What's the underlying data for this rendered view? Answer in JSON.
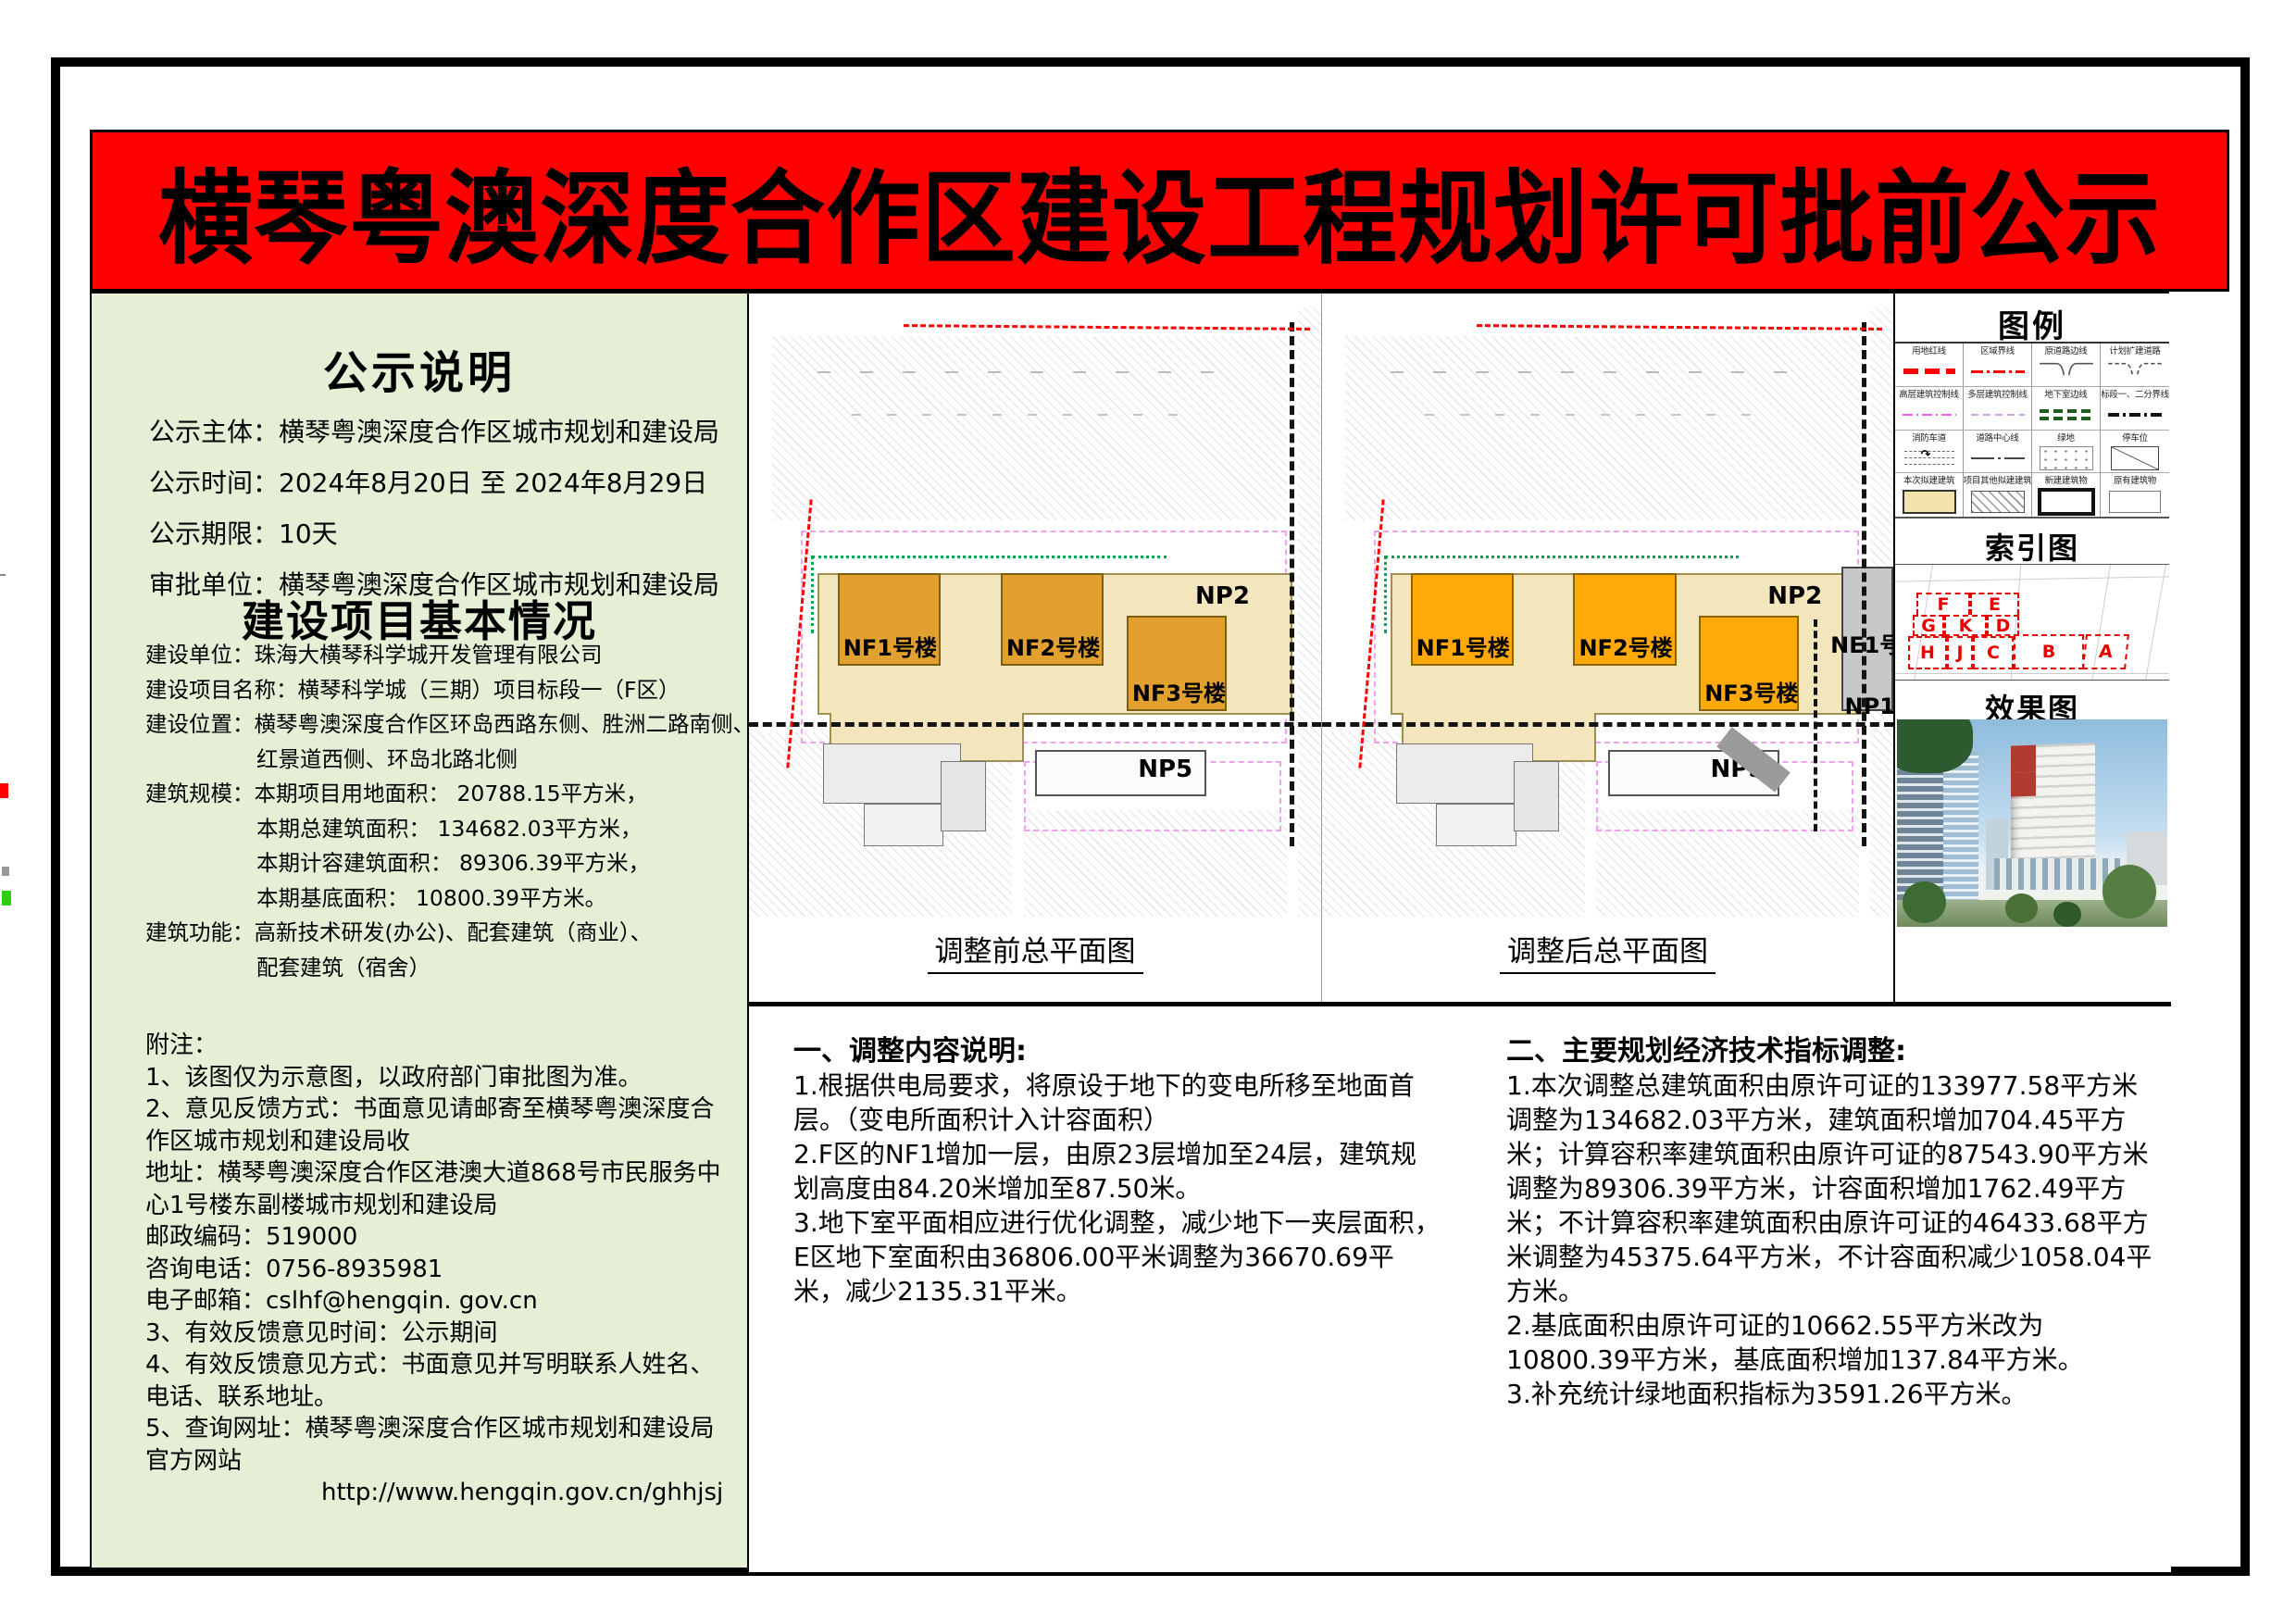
{
  "banner": {
    "title": "横琴粤澳深度合作区建设工程规划许可批前公示",
    "bg_color": "#FE0000",
    "text_color": "#000000"
  },
  "notice": {
    "title": "公示说明",
    "rows": [
      {
        "label": "公示主体：",
        "value": "横琴粤澳深度合作区城市规划和建设局"
      },
      {
        "label": "公示时间：",
        "value": "2024年8月20日  至  2024年8月29日"
      },
      {
        "label": "公示期限：",
        "value": "10天"
      },
      {
        "label": "审批单位：",
        "value": "横琴粤澳深度合作区城市规划和建设局"
      }
    ]
  },
  "project": {
    "title": "建设项目基本情况",
    "lines": [
      "建设单位：珠海大横琴科学城开发管理有限公司",
      "建设项目名称：横琴科学城（三期）项目标段一（F区）",
      "建设位置：横琴粤澳深度合作区环岛西路东侧、胜洲二路南侧、",
      "红景道西侧、环岛北路北侧",
      "建筑规模：本期项目用地面积：  20788.15平方米，",
      "本期总建筑面积：    134682.03平方米，",
      "本期计容建筑面积： 89306.39平方米，",
      "本期基底面积：     10800.39平方米。",
      "建筑功能：高新技术研发(办公)、配套建筑（商业）、",
      "配套建筑（宿舍）"
    ]
  },
  "notes": {
    "title": "附注：",
    "paragraphs": [
      "1、该图仅为示意图，以政府部门审批图为准。",
      "2、意见反馈方式：书面意见请邮寄至横琴粤澳深度合作区城市规划和建设局收",
      "地址：横琴粤澳深度合作区港澳大道868号市民服务中心1号楼东副楼城市规划和建设局",
      "邮政编码：519000",
      "咨询电话：0756-8935981",
      "电子邮箱：cslhf@hengqin. gov.cn",
      "3、有效反馈意见时间：公示期间",
      "4、有效反馈意见方式：书面意见并写明联系人姓名、电话、联系地址。",
      "5、查询网址：横琴粤澳深度合作区城市规划和建设局官方网站",
      "http://www.hengqin.gov.cn/ghhjsj"
    ]
  },
  "plans": {
    "before": {
      "caption": "调整前总平面图",
      "buildings": {
        "nf1": "NF1号楼",
        "nf2": "NF2号楼",
        "nf3": "NF3号楼",
        "np2": "NP2",
        "np5": "NP5"
      }
    },
    "after": {
      "caption": "调整后总平面图",
      "buildings": {
        "nf1": "NF1号楼",
        "nf2": "NF2号楼",
        "nf3": "NF3号楼",
        "np2": "NP2",
        "np5": "NP5",
        "ne1": "NE1号楼",
        "np1": "NP1"
      }
    },
    "colors": {
      "tower_before": "#E2A02F",
      "tower_after": "#FFA90A",
      "podium": "#F4E6BC",
      "boundary_red": "#FF0000",
      "control_magenta": "#F0A2F0",
      "green_line": "#00A651"
    }
  },
  "legend": {
    "title": "图例",
    "items": [
      {
        "label": "用地红线",
        "sym": "red-dash"
      },
      {
        "label": "区域界线",
        "sym": "red-dashdot"
      },
      {
        "label": "原道路边线",
        "sym": "road-edge"
      },
      {
        "label": "计划扩建道路",
        "sym": "road-planned"
      },
      {
        "label": "高层建筑控制线",
        "sym": "magenta-dashdot"
      },
      {
        "label": "多层建筑控制线",
        "sym": "purple-dash"
      },
      {
        "label": "地下室边线",
        "sym": "green-dash"
      },
      {
        "label": "标段一、二分界线",
        "sym": "black-dashdot"
      },
      {
        "label": "消防车道",
        "sym": "fire-lane"
      },
      {
        "label": "道路中心线",
        "sym": "centerline"
      },
      {
        "label": "绿地",
        "sym": "green-space"
      },
      {
        "label": "停车位",
        "sym": "parking"
      },
      {
        "label": "本次拟建建筑",
        "sym": "proposed"
      },
      {
        "label": "项目其他拟建建筑",
        "sym": "other-proposed"
      },
      {
        "label": "新建建筑物",
        "sym": "new-building"
      },
      {
        "label": "原有建筑物",
        "sym": "existing-building"
      }
    ]
  },
  "index_map": {
    "title": "索引图",
    "parcels": [
      "F",
      "E",
      "G",
      "K",
      "D",
      "H",
      "J",
      "C",
      "B",
      "A"
    ]
  },
  "render_view": {
    "title": "效果图"
  },
  "adjustments": {
    "title": "一、调整内容说明:",
    "paragraphs": [
      "1.根据供电局要求，将原设于地下的变电所移至地面首层。（变电所面积计入计容面积）",
      "2.F区的NF1增加一层，由原23层增加至24层，建筑规划高度由84.20米增加至87.50米。",
      "3.地下室平面相应进行优化调整，减少地下一夹层面积，E区地下室面积由36806.00平米调整为36670.69平米，减少2135.31平米。"
    ]
  },
  "indicators": {
    "title": "二、主要规划经济技术指标调整:",
    "paragraphs": [
      "1.本次调整总建筑面积由原许可证的133977.58平方米调整为134682.03平方米，建筑面积增加704.45平方米；计算容积率建筑面积由原许可证的87543.90平方米调整为89306.39平方米，计容面积增加1762.49平方米；不计算容积率建筑面积由原许可证的46433.68平方米调整为45375.64平方米，不计容面积减少1058.04平方米。",
      "2.基底面积由原许可证的10662.55平方米改为10800.39平方米，基底面积增加137.84平方米。",
      "3.补充统计绿地面积指标为3591.26平方米。"
    ]
  }
}
